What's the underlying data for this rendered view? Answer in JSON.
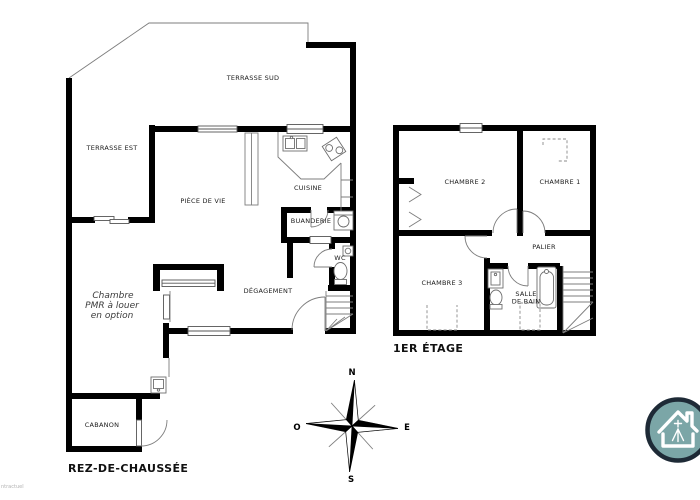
{
  "document": {
    "background": "#ffffff",
    "watermark": "ntractuel"
  },
  "ground_floor": {
    "title": "REZ-DE-CHAUSSÉE",
    "labels": {
      "terrasse_sud": "TERRASSE SUD",
      "terrasse_est": "TERRASSE EST",
      "piece_de_vie": "PIÈCE DE VIE",
      "cuisine": "CUISINE",
      "buanderie": "BUANDERIE",
      "wc": "WC",
      "degagement": "DÉGAGEMENT",
      "cabanon": "CABANON",
      "chambre_pmr": {
        "line1": "Chambre",
        "line2": "PMR à louer",
        "line3": "en option"
      }
    }
  },
  "first_floor": {
    "title": "1ER ÉTAGE",
    "labels": {
      "chambre_1": "CHAMBRE 1",
      "chambre_2": "CHAMBRE 2",
      "chambre_3": "CHAMBRE 3",
      "palier": "PALIER",
      "salle_de_bain": {
        "line1": "SALLE",
        "line2": "DE BAIN"
      }
    }
  },
  "compass": {
    "north": "N",
    "east": "E",
    "south": "S",
    "west": "O"
  },
  "logo": {
    "icon": "breton-house-logo",
    "teal": "#7BA6A7",
    "ring": "#1E2A36"
  },
  "colors": {
    "wall": "#000000",
    "thin_line": "#7d7d7d",
    "label_text": "#1a1a1a",
    "watermark": "#b3b3b3"
  }
}
